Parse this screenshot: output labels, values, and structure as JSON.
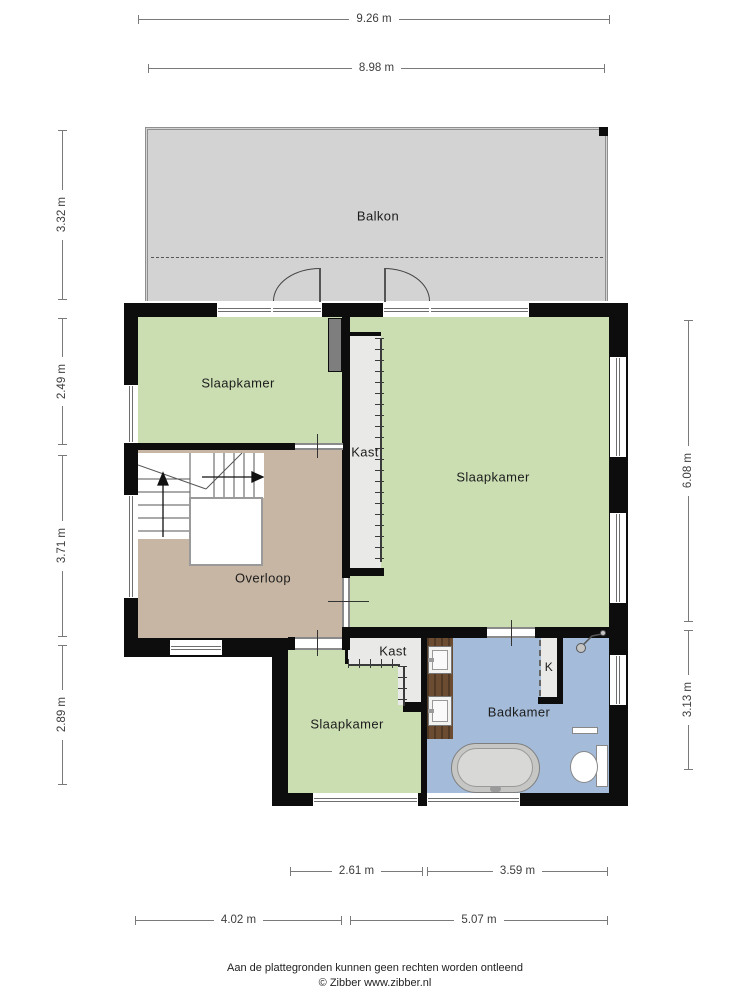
{
  "rooms": {
    "balkon": "Balkon",
    "slaapkamer_top_left": "Slaapkamer",
    "slaapkamer_right": "Slaapkamer",
    "slaapkamer_bottom": "Slaapkamer",
    "overloop": "Overloop",
    "kast_middle": "Kast",
    "kast_bottom": "Kast",
    "badkamer": "Badkamer",
    "kast_k": "K"
  },
  "dimensions": {
    "top": [
      "9.26 m",
      "8.98 m"
    ],
    "left": [
      "3.32 m",
      "2.49 m",
      "3.71 m",
      "2.89 m"
    ],
    "right": [
      "6.08 m",
      "3.13 m"
    ],
    "bottom_upper": [
      "2.61 m",
      "3.59 m"
    ],
    "bottom_lower": [
      "4.02 m",
      "5.07 m"
    ]
  },
  "footer": {
    "disclaimer": "Aan de plattegronden kunnen geen rechten worden ontleend",
    "copyright": "© Zibber www.zibber.nl"
  },
  "colors": {
    "room_green": "#cbdeb2",
    "room_tan": "#c7b6a3",
    "room_blue": "#a4bcda",
    "balcony_gray": "#d3d3d3",
    "closet_gray": "#e9e9e7",
    "wall_black": "#0d0d0d",
    "vanity_brown": "#6b4c31",
    "dim_gray": "#7a7a7a"
  }
}
